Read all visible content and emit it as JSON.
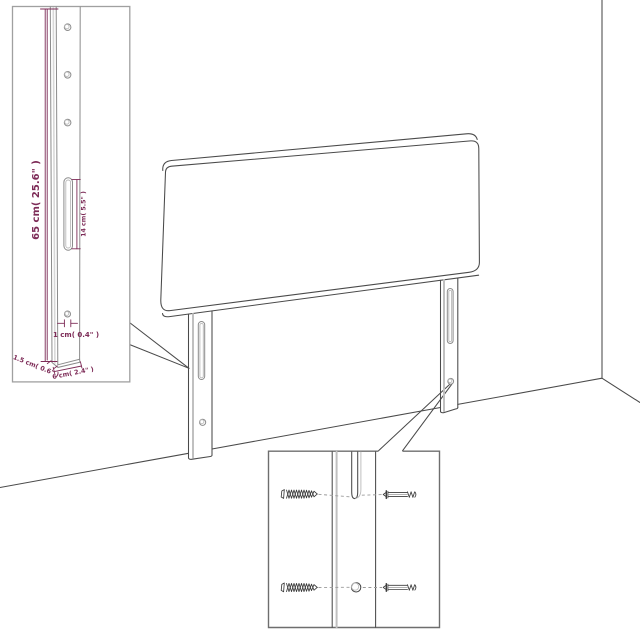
{
  "diagram": {
    "type": "product-assembly-dimension-diagram",
    "subject": "upholstered headboard with two slotted wall-mount legs",
    "insets": [
      {
        "name": "leg-detail",
        "position": "top-left",
        "content": "full leg with three holes, mounting slot and bottom hole"
      },
      {
        "name": "mounting-detail",
        "position": "bottom-center",
        "content": "slot and hole close-up with wood screws and bolts"
      }
    ]
  },
  "labels": {
    "leg_height": "65 cm( 25.6\" )",
    "slot_length": "14 cm( 5.5\" )",
    "hole_diameter": "1 cm( 0.4\" )",
    "leg_thickness": "1.5 cm( 0.6\" )",
    "leg_width": "6 cm( 2.4\" )"
  },
  "colors": {
    "background": "#ffffff",
    "outline": "#4a4a4a",
    "outline_light": "#c0c0c0",
    "detail_gray": "#8b8b8b",
    "dimension": "#7d2b57",
    "inset_border_light": "#a0a0a0",
    "inset_border_dark": "#6e6e6e",
    "screw": "#3c3c3c",
    "dash": "#9a9a9a"
  }
}
